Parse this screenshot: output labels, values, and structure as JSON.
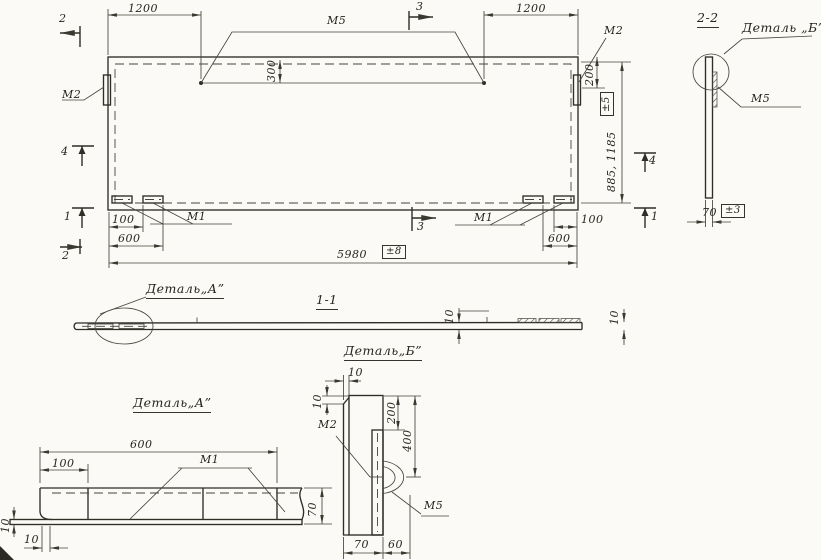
{
  "main": {
    "dim_1200_left": "1200",
    "dim_1200_right": "1200",
    "dim_300": "300",
    "dim_200_right": "200",
    "dim_height": "885, 1185",
    "tol_height": "±5",
    "dim_100_left": "100",
    "dim_600_left": "600",
    "dim_100_right": "100",
    "dim_600_right": "600",
    "dim_total": "5980",
    "tol_total": "±8",
    "label_m5": "М5",
    "label_m2_left": "М2",
    "label_m2_right": "М2",
    "label_m1_left": "М1",
    "label_m1_right": "М1",
    "marker_2_top": "2",
    "marker_4_left": "4",
    "marker_1_left": "1",
    "marker_2_bottom": "2",
    "marker_3_top": "3",
    "marker_3_bottom": "3",
    "marker_4_right": "4",
    "marker_1_right": "1"
  },
  "section_2_2": {
    "title": "2-2",
    "callout": "Деталь „Б”",
    "label_m5": "М5",
    "dim_70": "70",
    "tol_70": "±3"
  },
  "section_1_1": {
    "title": "1-1",
    "callout_a": "Деталь„А”",
    "dim_10_left": "10",
    "dim_10_right": "10"
  },
  "detail_a": {
    "title": "Деталь„А”",
    "dim_600": "600",
    "dim_100": "100",
    "label_m1": "М1",
    "dim_70": "70",
    "dim_10_left": "10",
    "dim_10_bottom": "10"
  },
  "detail_b": {
    "title": "Деталь„Б”",
    "dim_10_top": "10",
    "dim_10_left": "10",
    "label_m2": "М2",
    "label_m5": "М5",
    "dim_200": "200",
    "dim_400": "400",
    "dim_70": "70",
    "dim_60": "60"
  }
}
